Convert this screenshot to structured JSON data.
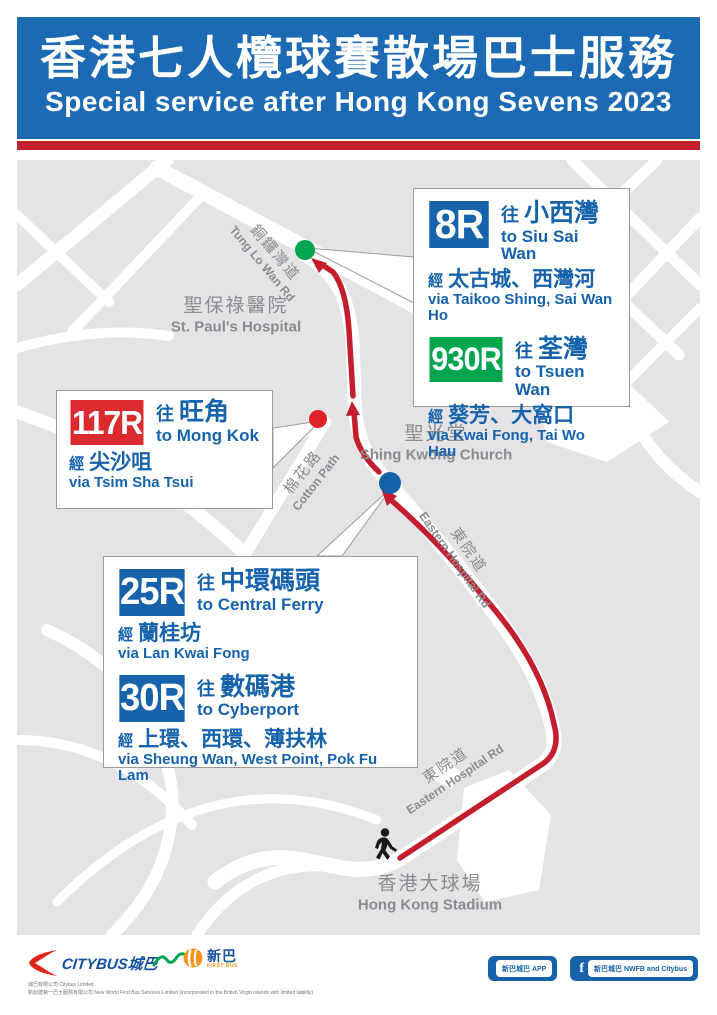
{
  "header": {
    "title_zh": "香港七人欖球賽散場巴士服務",
    "title_en": "Special service after Hong Kong Sevens 2023"
  },
  "common": {
    "to_prefix": "往",
    "via_prefix": "經"
  },
  "routes": [
    {
      "number": "8R",
      "badge_color": "#1663AC",
      "dest_zh": "小西灣",
      "dest_en": "to Siu Sai Wan",
      "via_zh": "太古城、西灣河",
      "via_en": "via Taikoo Shing, Sai Wan Ho"
    },
    {
      "number": "930R",
      "badge_color": "#00A550",
      "dest_zh": "荃灣",
      "dest_en": "to Tsuen Wan",
      "via_zh": "葵芳、大窩口",
      "via_en": "via Kwai Fong, Tai Wo Hau"
    },
    {
      "number": "117R",
      "badge_color": "#DC2B2E",
      "dest_zh": "旺角",
      "dest_en": "to Mong Kok",
      "via_zh": "尖沙咀",
      "via_en": "via Tsim Sha Tsui"
    },
    {
      "number": "25R",
      "badge_color": "#1663AC",
      "dest_zh": "中環碼頭",
      "dest_en": "to Central Ferry",
      "via_zh": "蘭桂坊",
      "via_en": "via Lan Kwai Fong"
    },
    {
      "number": "30R",
      "badge_color": "#1663AC",
      "dest_zh": "數碼港",
      "dest_en": "to Cyberport",
      "via_zh": "上環、西環、薄扶林",
      "via_en": "via Sheung Wan, West Point, Pok Fu Lam"
    }
  ],
  "map_labels": {
    "tung_lo_wan": {
      "zh": "銅鑼灣道",
      "en": "Tung Lo Wan Rd"
    },
    "st_pauls": {
      "zh": "聖保祿醫院",
      "en": "St. Paul's Hospital"
    },
    "shing_kwong": {
      "zh": "聖光堂",
      "en": "Shing Kwong Church"
    },
    "cotton_path": {
      "zh": "棉花路",
      "en": "Cotton Path"
    },
    "eastern_upper": {
      "zh": "東院道",
      "en": "Eastern Hospital Rd"
    },
    "eastern_lower": {
      "zh": "東院道",
      "en": "Eastern Hospital Rd"
    },
    "stadium": {
      "zh": "香港大球場",
      "en": "Hong Kong Stadium"
    }
  },
  "map": {
    "route_color": "#C41E2E",
    "stops": [
      {
        "id": "tung-lo-wan-stop",
        "color": "#00A551",
        "serves": [
          "8R",
          "930R"
        ]
      },
      {
        "id": "cotton-path-stop",
        "color": "#E02228",
        "serves": [
          "117R"
        ]
      },
      {
        "id": "eastern-hospital-rd-stop",
        "color": "#1663AC",
        "serves": [
          "25R",
          "30R"
        ]
      }
    ],
    "origin_walk_from": "Hong Kong Stadium"
  },
  "footer": {
    "citybus_logo_text": "CITYBUS城巴",
    "firstbus_logo_zh": "新巴",
    "firstbus_logo_en": "FIRST BUS",
    "app_button": "新巴城巴 APP",
    "social_button": "新巴城巴 NWFB and Citybus",
    "fine_print_1": "城巴有限公司 Citybus Limited",
    "fine_print_2": "新創建第一巴士服務有限公司 New World First Bus Services Limited (incorporated in the British Virgin Islands with limited liability)"
  },
  "colors": {
    "header_blue": "#1B6AB3",
    "accent_red": "#C4202B",
    "text_blue": "#1663AC",
    "map_block_gray": "#E4E4E6",
    "label_gray": "#8A8C8F"
  }
}
